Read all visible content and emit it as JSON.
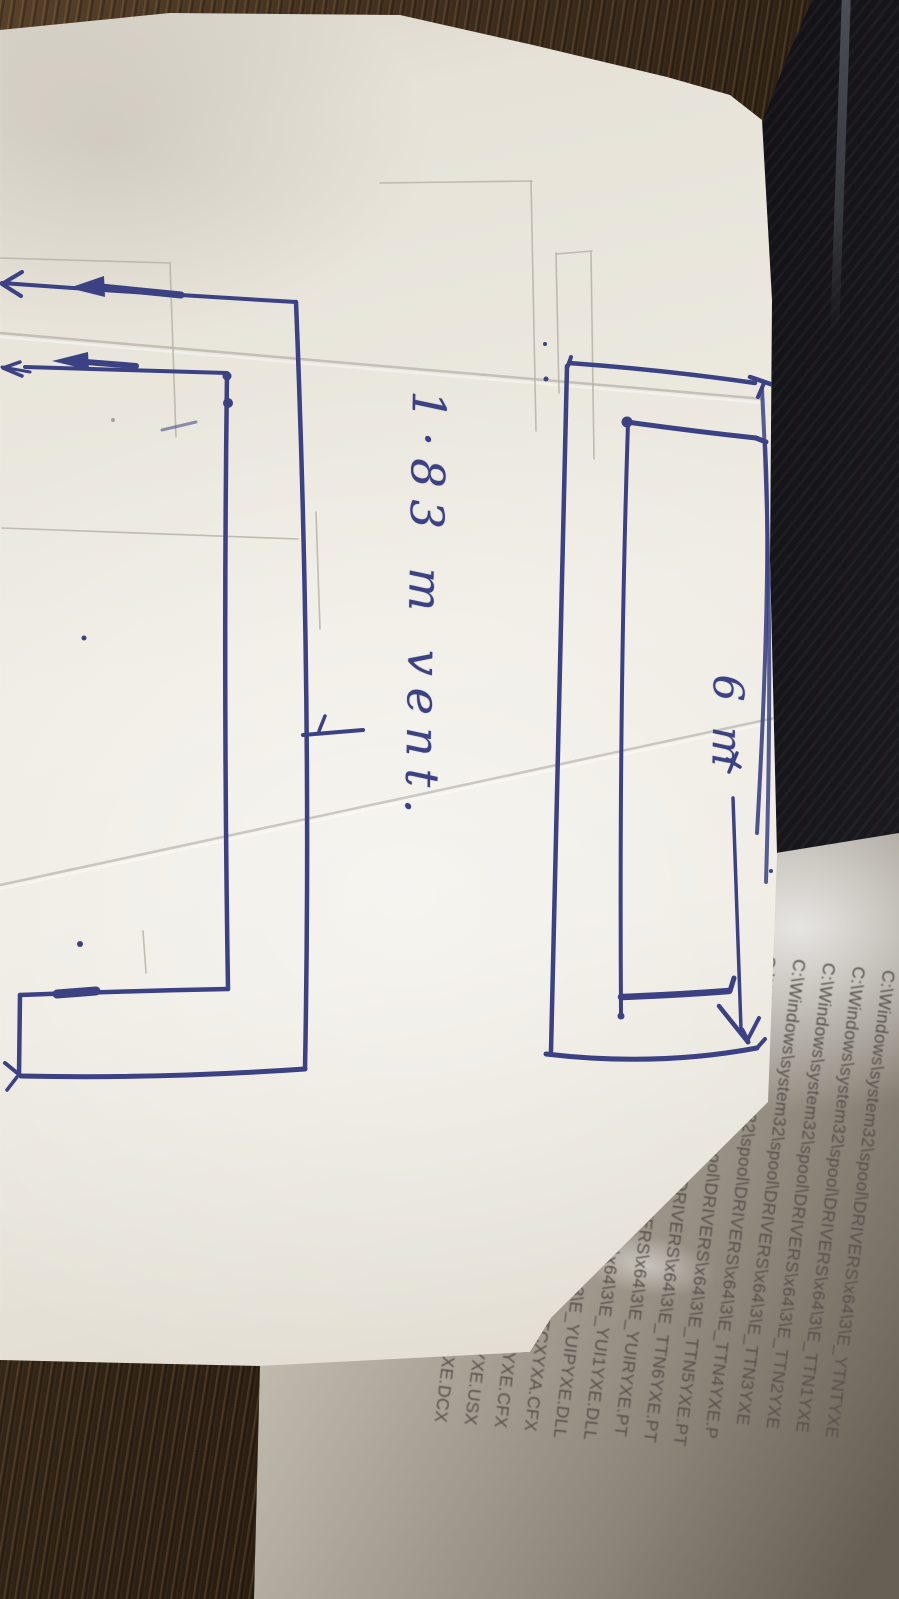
{
  "sketch": {
    "vent_label": "1·83 m vent.",
    "width_label": "6 m"
  },
  "printed_paper": {
    "lines": [
      "C:\\Windows\\system32\\spool\\DRIVERS\\x64\\3\\E_YTNTYXE",
      "C:\\Windows\\system32\\spool\\DRIVERS\\x64\\3\\E_TTN1YXE",
      "C:\\Windows\\system32\\spool\\DRIVERS\\x64\\3\\E_TTN2YXE",
      "C:\\Windows\\system32\\spool\\DRIVERS\\x64\\3\\E_TTN3YXE",
      "C:\\Windows\\system32\\spool\\DRIVERS\\x64\\3\\E_TTN4YXE.P",
      "C:\\Windows\\system32\\spool\\DRIVERS\\x64\\3\\E_TTN5YXE.PT",
      "C:\\Windows\\system32\\spool\\DRIVERS\\x64\\3\\E_TTN6YXE.PT",
      "C:\\Windows\\system32\\spool\\DRIVERS\\x64\\3\\E_YUIRYXE.PT",
      "C:\\Windows\\system32\\spool\\DRIVERS\\x64\\3\\E_YUI1YXE.DLL",
      "C:\\Windows\\system32\\spool\\DRIVERS\\x64\\3\\E_YUIPYXE.DLL",
      "C:\\Windows\\system32\\spool\\DRIVERS\\x64\\3\\E_TCXYXA.CFX",
      "C:\\Windows\\system32\\spool\\DRIVERS\\x64\\3\\E_TCXYXE.CFX",
      "C:\\Windows\\system32\\spool\\DRIVERS\\x64\\3\\E_TCXYXE.USX",
      "C:\\Windows\\system32\\spool\\DRIVERS\\x64\\3\\E_TCXYXE.DCX"
    ]
  },
  "colors": {
    "ink": "#3b4183",
    "pencil": "#b8b2a6",
    "print_text": "#55514b",
    "sketch_paper": "#e9e5db",
    "printed_paper": "#ddd9cf",
    "wood_dark": "#241a10",
    "wood_light": "#55402a",
    "black_object": "#1b1a1e"
  }
}
